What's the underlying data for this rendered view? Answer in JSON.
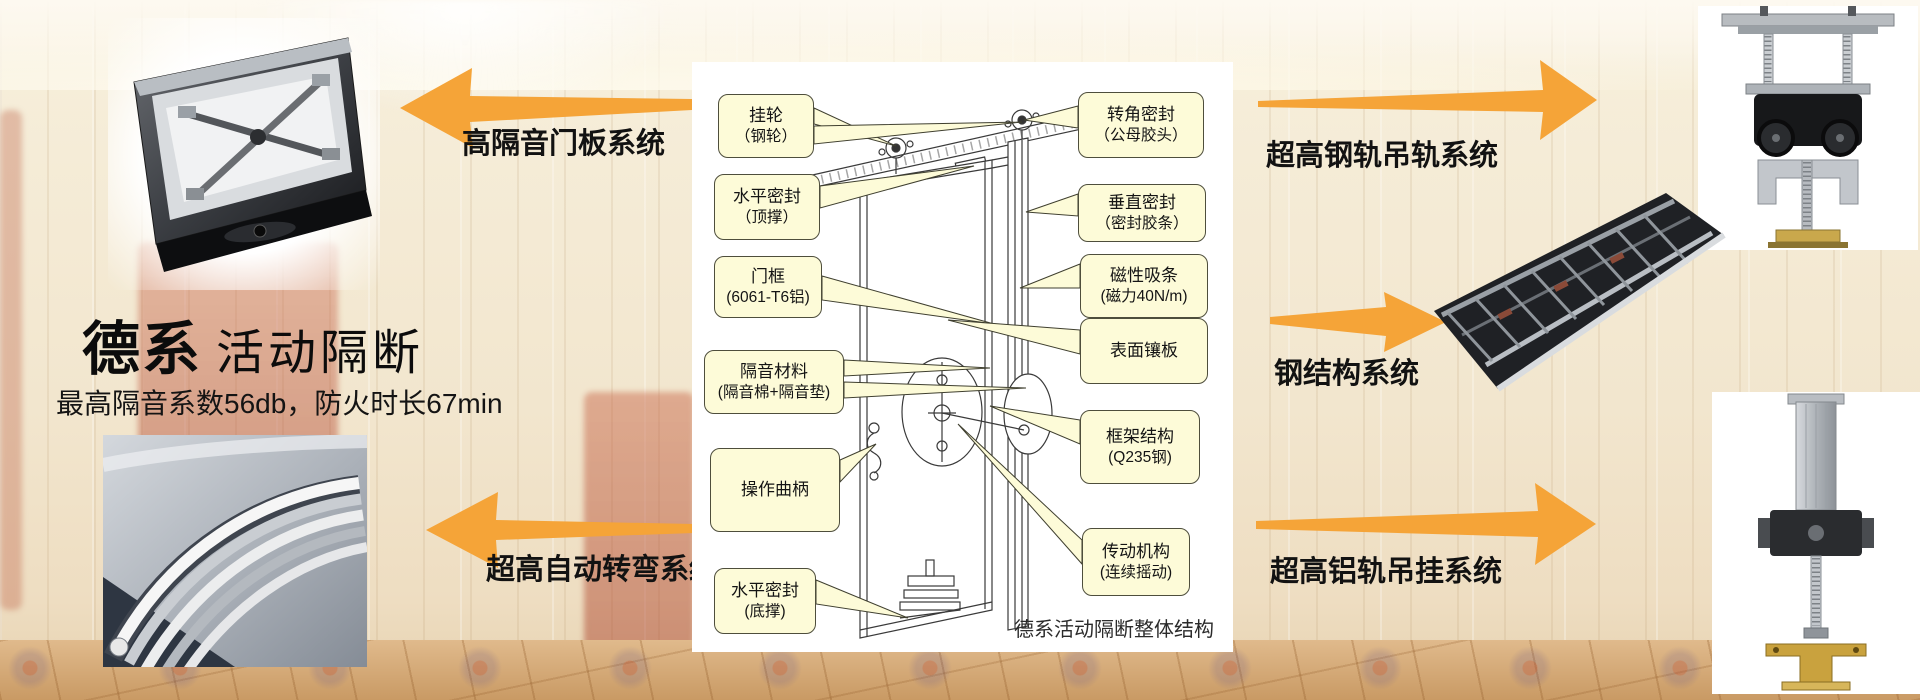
{
  "slide": {
    "title_brand": "德系",
    "title_product": "活动隔断",
    "subtitle": "最高隔音系数56db，防火时长67min"
  },
  "system_labels": {
    "top_left": "高隔音门板系统",
    "bottom_left": "超高自动转弯系统",
    "top_right": "超高钢轨吊轨系统",
    "mid_right": "钢结构系统",
    "bottom_right": "超高铝轨吊挂系统"
  },
  "diagram": {
    "caption": "德系活动隔断整体结构",
    "left_callouts": [
      {
        "line1": "挂轮",
        "line2": "（钢轮）"
      },
      {
        "line1": "水平密封",
        "line2": "（顶撑）"
      },
      {
        "line1": "门框",
        "line2": "(6061-T6铝)"
      },
      {
        "line1": "隔音材料",
        "line2": "(隔音棉+隔音垫)"
      },
      {
        "line1": "操作曲柄",
        "line2": ""
      },
      {
        "line1": "水平密封",
        "line2": "(底撑)"
      }
    ],
    "right_callouts": [
      {
        "line1": "转角密封",
        "line2": "（公母胶头）"
      },
      {
        "line1": "垂直密封",
        "line2": "（密封胶条）"
      },
      {
        "line1": "磁性吸条",
        "line2": "(磁力40N/m)"
      },
      {
        "line1": "表面镶板",
        "line2": ""
      },
      {
        "line1": "框架结构",
        "line2": "(Q235钢)"
      },
      {
        "line1": "传动机构",
        "line2": "(连续摇动)"
      }
    ]
  },
  "colors": {
    "arrow": "#F5A438",
    "callout-bg": "#FDFBD8",
    "callout-border": "#4E4E3C"
  }
}
